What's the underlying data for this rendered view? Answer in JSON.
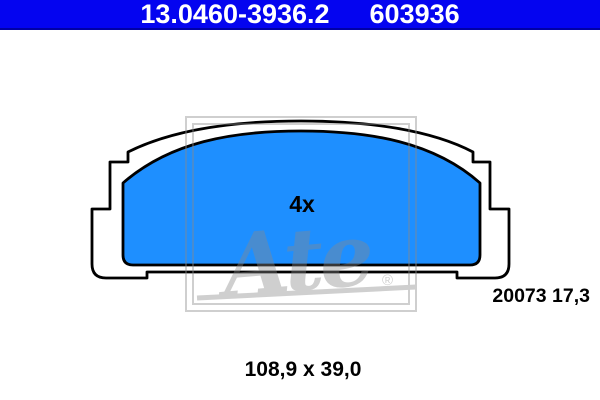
{
  "header": {
    "part_number": "13.0460-3936.2",
    "reference_number": "603936",
    "background_color": "#0404f0",
    "underline_color": "#0000a6",
    "text_color": "#ffffff"
  },
  "diagram": {
    "quantity_label": "4x",
    "batch_label": "20073 17,3",
    "pad_fill_color": "#1e8fff",
    "outline_color": "#000000"
  },
  "watermark": {
    "logo_text": "Ate",
    "registered_mark": "®",
    "color": "#8a8a8a"
  },
  "footer": {
    "dimensions": "108,9 x 39,0"
  }
}
